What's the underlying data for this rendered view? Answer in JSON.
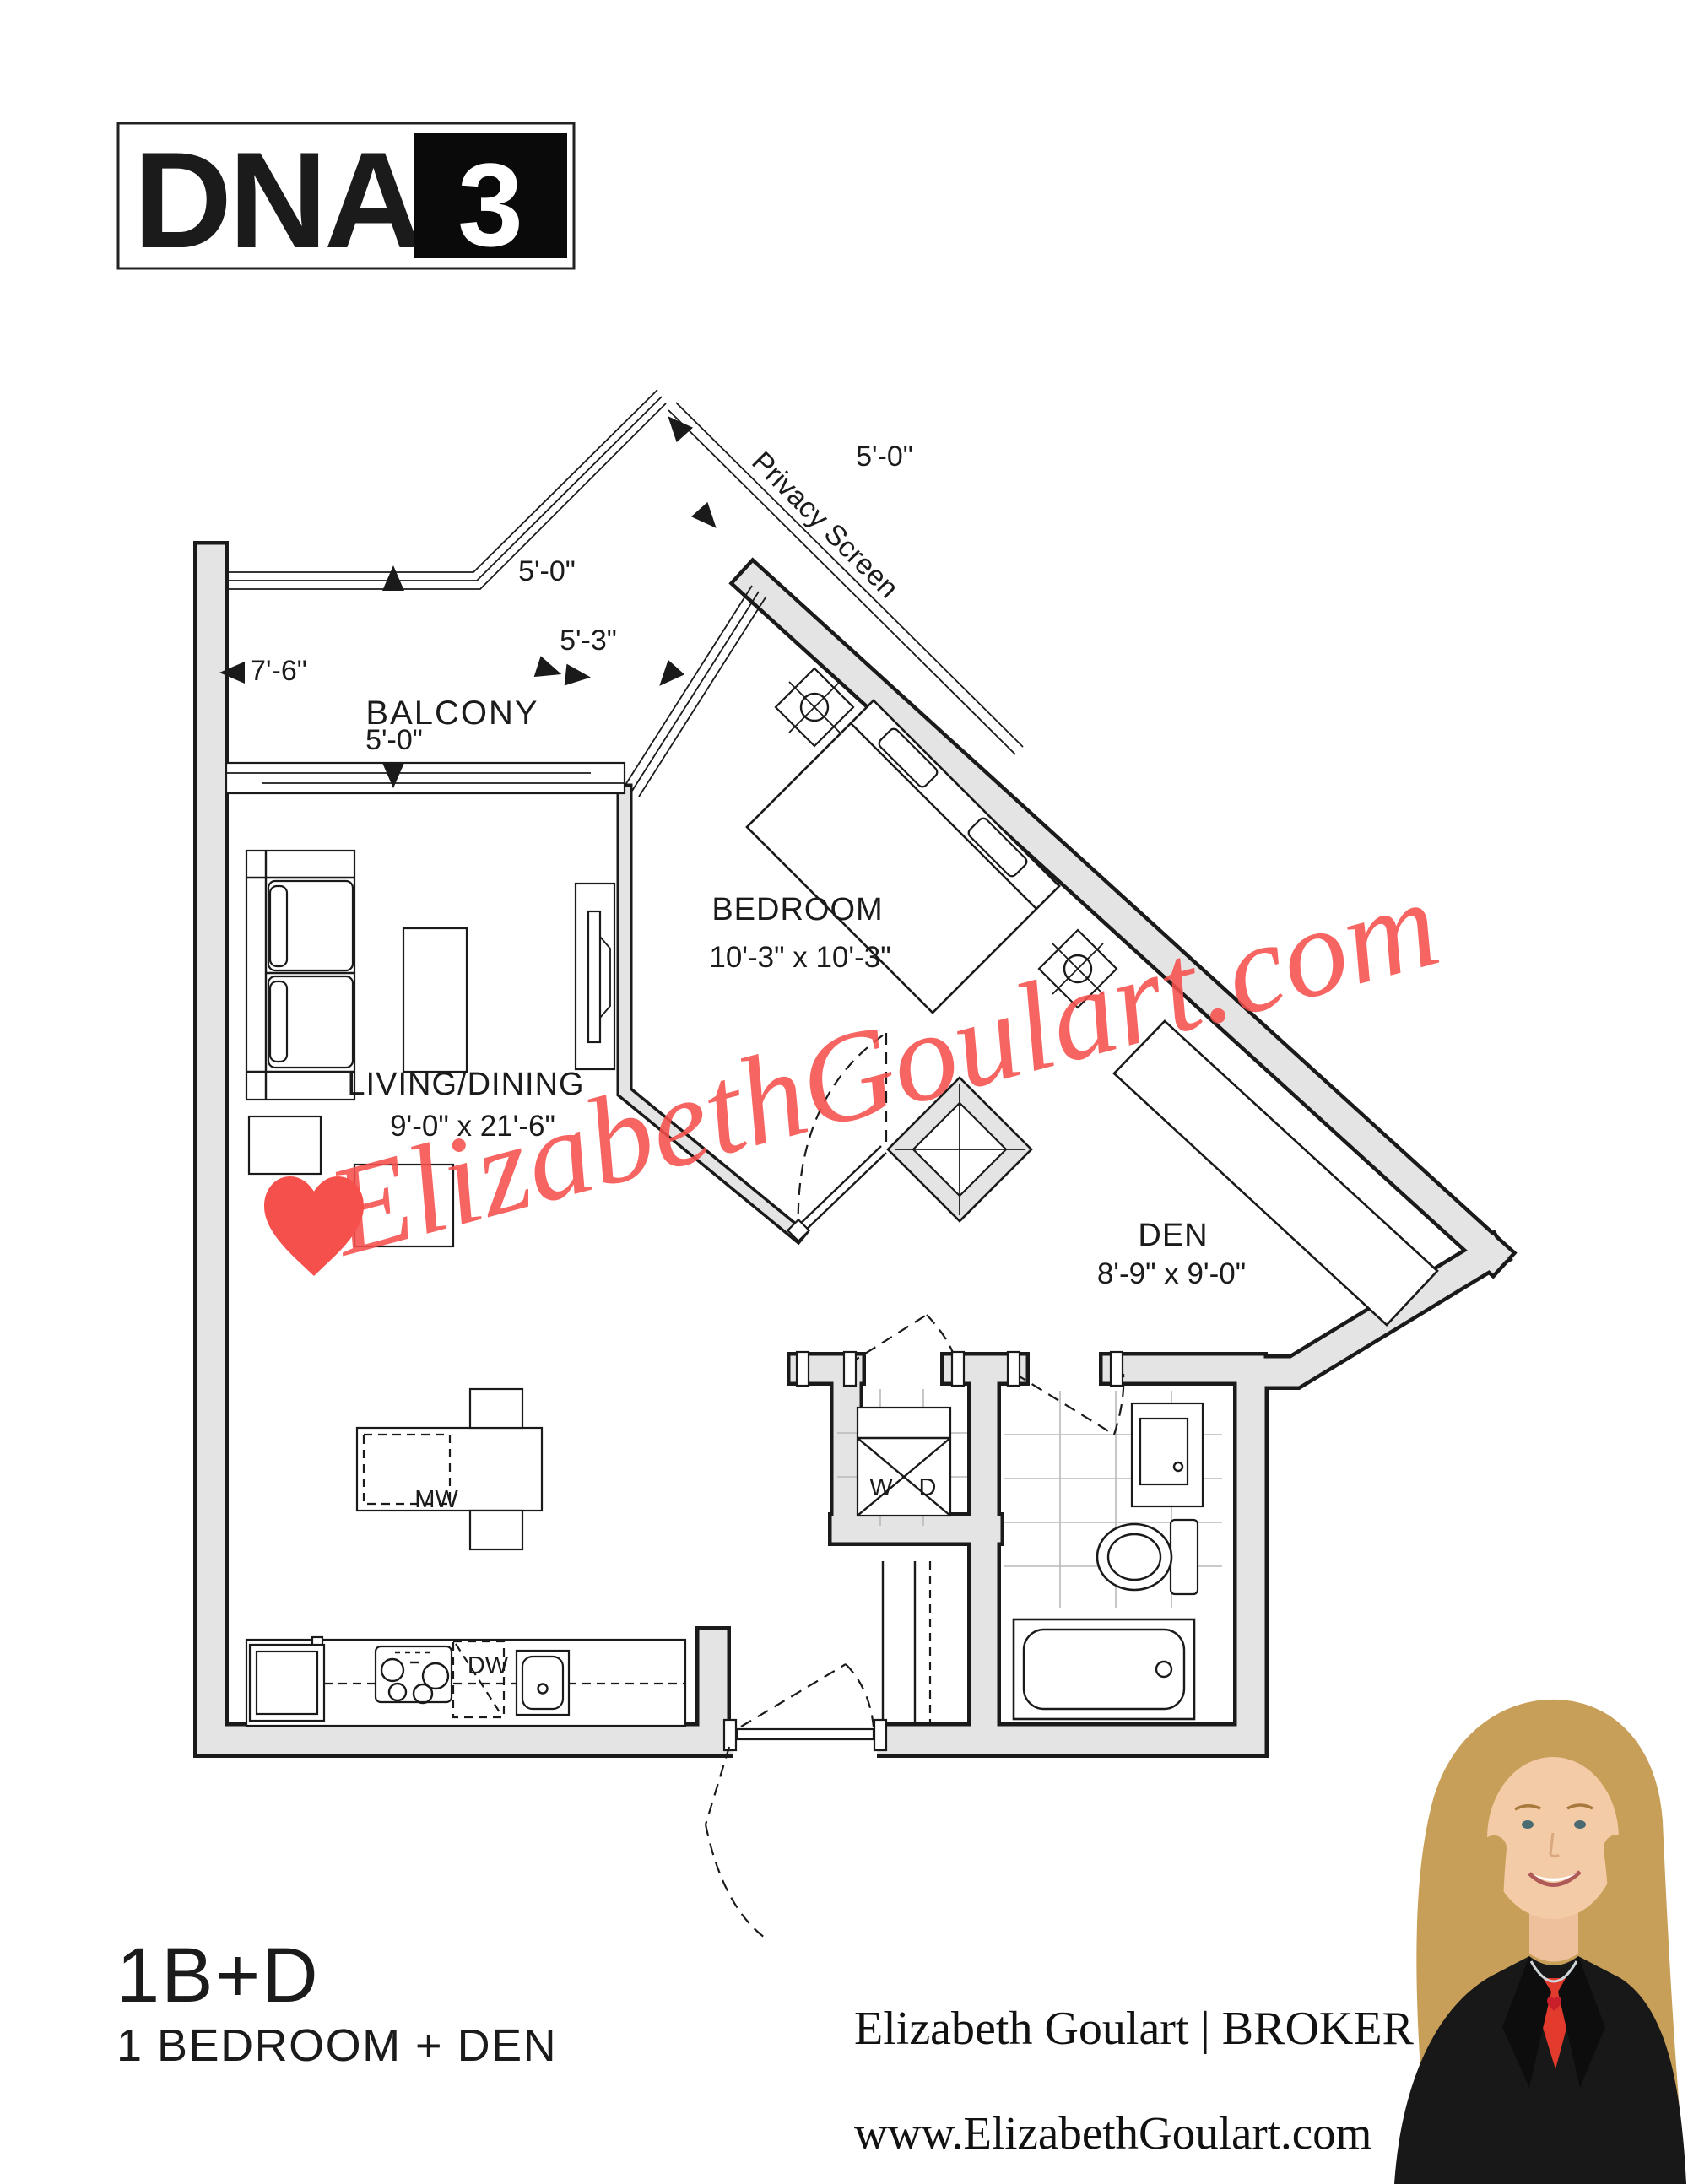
{
  "logo": {
    "name": "DNA",
    "number": "3"
  },
  "plan": {
    "privacy_screen": "Privacy Screen",
    "balcony_label": "BALCONY",
    "dims": {
      "balcony_top": "5'-0\"",
      "balcony_top_right": "5'-0\"",
      "balcony_left": "7'-6\"",
      "balcony_window": "5'-3\"",
      "balcony_bottom": "5'-0\""
    },
    "rooms": {
      "bedroom": {
        "label": "BEDROOM",
        "size": "10'-3\" x 10'-3\""
      },
      "living": {
        "label": "LIVING/DINING",
        "size": "9'-0\" x 21'-6\""
      },
      "den": {
        "label": "DEN",
        "size": "8'-9\" x 9'-0\""
      }
    },
    "appliances": {
      "microwave": "MW",
      "dishwasher": "DW",
      "washer": "W",
      "dryer": "D"
    }
  },
  "watermark": {
    "text": "ElizabethGoulart.com",
    "color": "#f5504c"
  },
  "footer": {
    "unit_code": "1B+D",
    "unit_desc": "1 BEDROOM + DEN",
    "broker_name": "Elizabeth Goulart",
    "broker_sep": " | ",
    "broker_title": "BROKER",
    "website": "www.ElizabethGoulart.com"
  },
  "colors": {
    "wall_fill": "#e4e4e4",
    "line": "#1a1a1a",
    "accent_red": "#f5504c"
  }
}
